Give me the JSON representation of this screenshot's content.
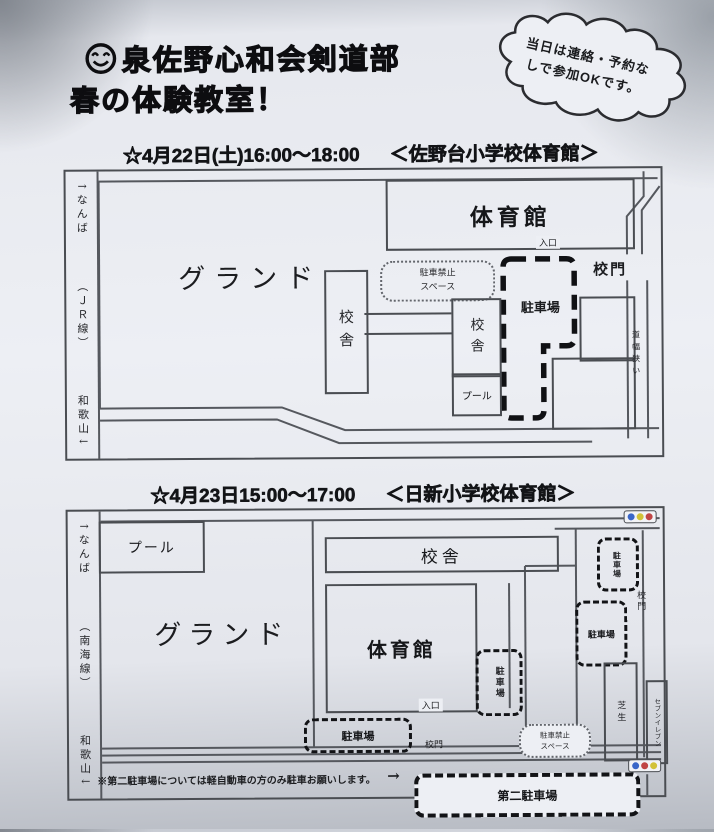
{
  "header": {
    "title_line1": "泉佐野心和会剣道部",
    "title_line2": "春の体験教室！",
    "bubble": {
      "line1": "当日は連絡・予約な",
      "line2": "しで参加OKです。"
    }
  },
  "map1": {
    "heading": {
      "date": "☆4月22日(土)16:00～18:00",
      "venue": "＜佐野台小学校体育館＞"
    },
    "rail": {
      "top": "↑なんば",
      "mid": "（ＪＲ線）",
      "bottom": "和歌山↓"
    },
    "labels": {
      "ground": "グランド",
      "gym": "体育館",
      "entrance": "入口",
      "no_parking_1": "駐車禁止",
      "no_parking_2": "スペース",
      "bldg_left": "校舎",
      "bldg_right": "校舎",
      "pool": "プール",
      "parking": "駐車場",
      "gate": "校門",
      "narrow_road": "道幅狭い"
    }
  },
  "map2": {
    "heading": {
      "date": "☆4月23日15:00～17:00",
      "venue": "＜日新小学校体育館＞"
    },
    "rail": {
      "top": "↑なんば",
      "mid": "（南海線）",
      "bottom": "和歌山↓"
    },
    "labels": {
      "pool": "プール",
      "ground": "グランド",
      "school_bldg": "校舎",
      "gym": "体育館",
      "entrance": "入口",
      "parking_side": "駐車場",
      "parking_top": "駐車場",
      "parking_mid": "駐車場",
      "parking_bottom_left": "駐車場",
      "gate_right": "校門",
      "gate_bottom": "校門",
      "lawn": "芝生",
      "no_parking_1": "駐車禁止",
      "no_parking_2": "スペース",
      "seven_eleven": "セブンイレブン",
      "second_parking": "第二駐車場"
    },
    "note": {
      "text": "※第二駐車場については軽自動車の方のみ駐車お願いします。",
      "arrow": "→"
    }
  },
  "icons": {
    "smiley": "smiley-icon",
    "traffic_light": "traffic-light-icon"
  },
  "colors": {
    "paper": "#edeff4",
    "line": "#4a4d52",
    "ink": "#16171a",
    "traffic_blue": "#3a66c8",
    "traffic_yellow": "#d2c238",
    "traffic_red": "#c04545"
  }
}
